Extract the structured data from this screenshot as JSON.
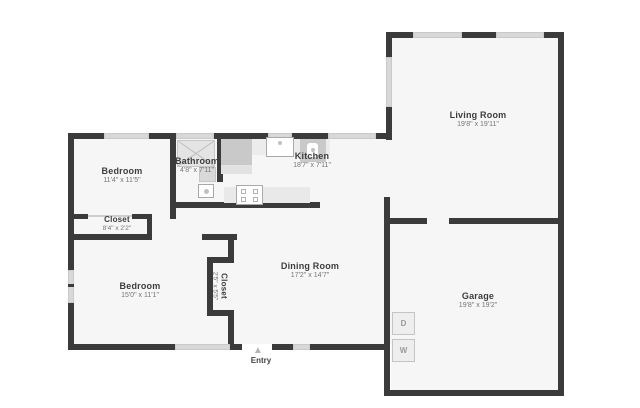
{
  "plan": {
    "type": "residential-floor-plan",
    "colors": {
      "background": "#ffffff",
      "floor": "#f6f6f6",
      "wall": "#3b3b3b",
      "window": "#d8d8d8",
      "fixture_gray": "#c9c9c9",
      "label_text": "#3d3d3d",
      "dim_text": "#757575"
    }
  },
  "rooms": [
    {
      "id": "bedroom-1",
      "name": "Bedroom",
      "dims": "11'4\" x 11'5\""
    },
    {
      "id": "bathroom",
      "name": "Bathroom",
      "dims": "4'8\" x 7'11\""
    },
    {
      "id": "kitchen",
      "name": "Kitchen",
      "dims": "18'7\" x 7'11\""
    },
    {
      "id": "living-room",
      "name": "Living Room",
      "dims": "19'8\" x 19'11\""
    },
    {
      "id": "closet-hall",
      "name": "Closet",
      "dims": "8'4\" x 2'2\""
    },
    {
      "id": "bedroom-2",
      "name": "Bedroom",
      "dims": "15'0\" x 11'1\""
    },
    {
      "id": "closet-bedroom",
      "name": "Closet",
      "dims": "2'5\" x 5'5\""
    },
    {
      "id": "dining-room",
      "name": "Dining Room",
      "dims": "17'2\" x 14'7\""
    },
    {
      "id": "garage",
      "name": "Garage",
      "dims": "19'8\" x 19'2\""
    }
  ],
  "entry": {
    "label": "Entry",
    "arrow": "▲"
  },
  "laundry": {
    "dryer_label": "D",
    "washer_label": "W"
  },
  "fixture_icons": [
    "shower-icon",
    "vanity-sink-icon",
    "toilet-icon",
    "refrigerator-icon",
    "kitchen-sink-icon",
    "range-icon",
    "stove-cooktop-icon",
    "counter",
    "washer-box",
    "dryer-box",
    "entry-arrow-icon"
  ]
}
